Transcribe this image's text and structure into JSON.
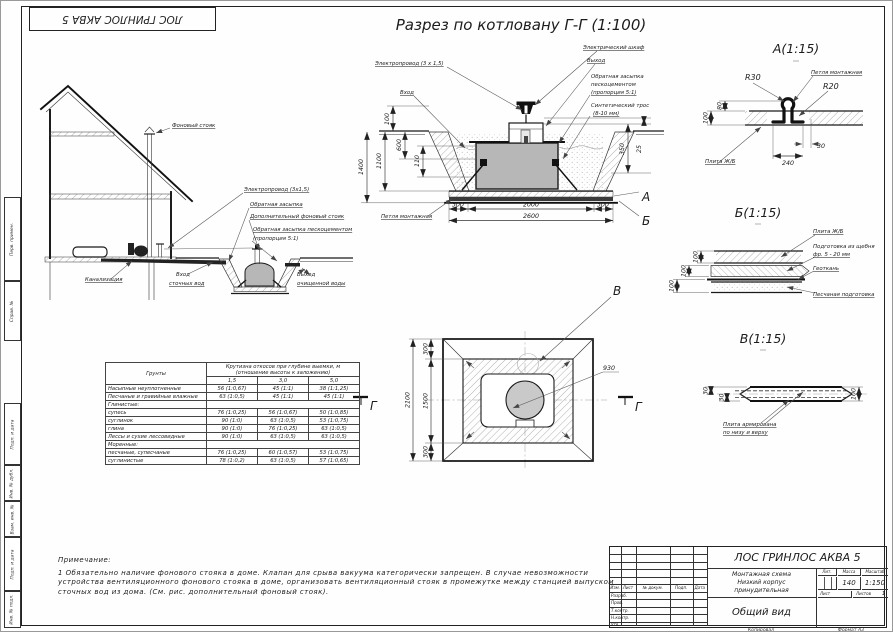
{
  "sheet": {
    "main_title": "Разрез по котловану Г-Г (1:100)",
    "stamp_top_inverted": "ЛОС ГРИНЛОС АКВА 5",
    "kopiroval": "Копировал",
    "format_label": "Формат",
    "format_value": "А3"
  },
  "frame_side_labels": {
    "perv_primen": "Перв. примен.",
    "sprav_no": "Справ. №",
    "podp_data_1": "Подп. и дата",
    "inv_no_dubl": "Инв. № дубл.",
    "vzam_inv_no": "Взам. инв. №",
    "podp_data_2": "Подп. и дата",
    "inv_no_podl": "Инв. № подл."
  },
  "house_view": {
    "riser": "Фоновый стояк",
    "wire": "Электропровод (3х1,5)",
    "backfill": "Обратная засыпка",
    "extra_riser": "Дополнительный фоновый стояк",
    "backfill_cement": "Обратная засыпка пескоцементом",
    "backfill_prop": "(пропорция 5:1)",
    "sewer": "Канализация",
    "inlet_l1": "Вход",
    "inlet_l2": "сточных вод",
    "outlet_l1": "Выход",
    "outlet_l2": "очищенной воды"
  },
  "pit_section": {
    "wire": "Электропровод (3 х 1,5)",
    "inlet": "Вход",
    "cabinet": "Электрический шкаф",
    "outlet": "Выход",
    "backfill_l1": "Обратная засыпка",
    "backfill_l2": "пескоцементом",
    "backfill_l3": "(пропорция 5:1)",
    "rope_l1": "Синтетический трос",
    "rope_l2": "(8-10 мм)",
    "loop": "Петля монтажная",
    "callout_a": "А",
    "callout_b": "Б",
    "dim_100": "100",
    "dim_1400": "1400",
    "dim_1100": "1100",
    "dim_600": "600",
    "dim_110": "110",
    "dim_350": "350",
    "dim_25": "25",
    "dim_300l": "300",
    "dim_2000": "2000",
    "dim_300r": "300",
    "dim_2600": "2600"
  },
  "detail_a": {
    "title": "А(1:15)",
    "r30": "R30",
    "r20": "R20",
    "loop": "Петля монтажная",
    "slab": "Плита Ж/Б",
    "dim_80": "80",
    "dim_100": "100",
    "dim_30": "30",
    "dim_240": "240"
  },
  "detail_b": {
    "title": "Б(1:15)",
    "slab": "Плита Ж/Б",
    "gravel_l1": "Подготовка из щебня",
    "gravel_l2": "фр. 5 - 20 мм",
    "geotextile": "Геоткань",
    "sand": "Песчаная подготовка",
    "dim_100_1": "100",
    "dim_100_2": "100",
    "dim_100_3": "100"
  },
  "detail_v": {
    "title": "В(1:15)",
    "reinf_l1": "Плита армирована",
    "reinf_l2": "по низу и верху",
    "dim_30_1": "30",
    "dim_30_2": "30",
    "dim_100": "100"
  },
  "plan_view": {
    "callout_v": "В",
    "dia": "930",
    "dim_300t": "300",
    "dim_1500": "1500",
    "dim_300b": "300",
    "dim_2100": "2100",
    "sec_left": "Г",
    "sec_right": "Г"
  },
  "slope_table": {
    "col_soils": "Грунты",
    "span_l1": "Крутизна откосов при глубине выемки, м",
    "span_l2": "(отношение высоты к заложению)",
    "depths": [
      "1,5",
      "3,0",
      "5,0"
    ],
    "rows": [
      {
        "name": "Насыпные неуплотненные",
        "v1": "56 (1:0,67)",
        "v2": "45 (1:1)",
        "v3": "38 (1:1,25)"
      },
      {
        "name": "Песчаные и гравийные влажные",
        "v1": "63 (1:0,5)",
        "v2": "45 (1:1)",
        "v3": "45 (1:1)"
      },
      {
        "name": "Глинистые:"
      },
      {
        "name": "супесь",
        "v1": "76 (1:0,25)",
        "v2": "56 (1:0,67)",
        "v3": "50 (1:0,85)"
      },
      {
        "name": "суглинок",
        "v1": "90 (1:0)",
        "v2": "63 (1:0,5)",
        "v3": "53 (1:0,75)"
      },
      {
        "name": "глина",
        "v1": "90 (1:0)",
        "v2": "76 (1:0,25)",
        "v3": "63 (1:0,5)"
      },
      {
        "name": "Лессы и сухие лессовидные",
        "v1": "90 (1:0)",
        "v2": "63 (1:0,5)",
        "v3": "63 (1:0,5)"
      },
      {
        "name": "Моренные:"
      },
      {
        "name": "песчаные, супесчаные",
        "v1": "76 (1:0,25)",
        "v2": "60 (1:0,57)",
        "v3": "53 (1:0,75)"
      },
      {
        "name": "суглинистые",
        "v1": "78 (1:0,2)",
        "v2": "63 (1:0,5)",
        "v3": "57 (1:0,65)"
      }
    ]
  },
  "notes": {
    "title": "Примечание:",
    "line1": "1 Обязательно наличие фонового стояка в доме. Клапан для срыва вакуума категорически запрещен. В случае невозможности",
    "line2": "устройства вентиляционного фонового стояка в доме, организовать вентиляционный стояк в промежутке между станцией выпуском",
    "line3": "сточных вод из дома. (См. рис. дополнительный фоновый стояк)."
  },
  "title_block": {
    "product": "ЛОС ГРИНЛОС АКВА 5",
    "doc_l1": "Монтажная схема",
    "doc_l2": "Низкий корпус",
    "doc_l3": "принудительная",
    "view_name": "Общий вид",
    "hdr_izm": "Изм.",
    "hdr_list": "Лист",
    "hdr_ndoc": "№ докум.",
    "hdr_podp": "Подп.",
    "hdr_data": "Дата",
    "row_razrab": "Разраб.",
    "row_prov": "Пров.",
    "row_tkontr": "Т.контр.",
    "row_nkontr": "Н.контр.",
    "row_utv": "Утв.",
    "lit_label": "Лит.",
    "massa_label": "Масса",
    "masshtab_label": "Масштаб",
    "massa_value": "140",
    "masshtab_value": "1:150",
    "list_label": "Лист",
    "listov_label": "Листов",
    "listov_value": "1"
  }
}
